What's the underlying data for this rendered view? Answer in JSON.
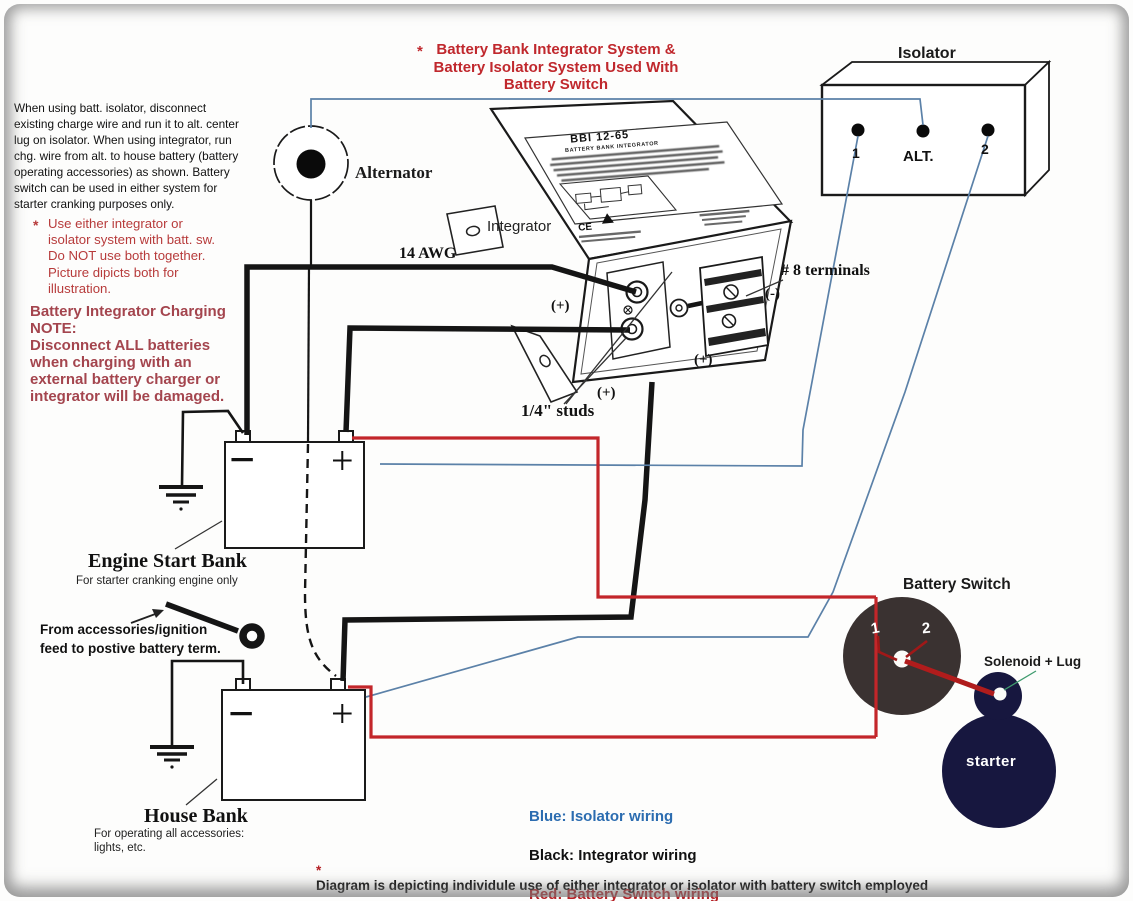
{
  "title": {
    "asterisk": "*",
    "line1": "Battery Bank Integrator System &",
    "line2": "Battery Isolator System Used With",
    "line3": "Battery Switch",
    "color": "#c0282d"
  },
  "intro_note": "When using batt. isolator, disconnect\n existing charge wire and run it to alt. center\nlug on isolator.  When using  integrator, run\nchg. wire from alt. to house battery (battery\noperating accessories) as shown. Battery\nswitch can be used in either system for\nstarter cranking purposes only.",
  "usage_note": {
    "asterisk": "*",
    "text": "Use either integrator or\nisolator system with batt. sw.\nDo NOT use both together.\nPicture dipicts both for\nillustration."
  },
  "charging_note": "Battery Integrator Charging\nNOTE:\nDisconnect ALL batteries\nwhen charging with an\nexternal battery charger or\nintegrator will be damaged.",
  "alternator": {
    "label": "Alternator"
  },
  "integrator": {
    "label": "Integrator",
    "device_title": "BBI 12-65",
    "device_subtitle": "BATTERY BANK INTEGRATOR",
    "ce_mark": "CE",
    "wire_gauge": "14 AWG",
    "terminals_label": "# 8 terminals",
    "studs_label": "1/4\" studs",
    "plus_upper": "(+)",
    "plus_lower": "(+)",
    "plus_block": "(+)",
    "minus_label": "(-)"
  },
  "isolator": {
    "title": "Isolator",
    "terminal_1": "1",
    "terminal_alt": "ALT.",
    "terminal_2": "2"
  },
  "engine_bank": {
    "title": "Engine Start Bank",
    "subtitle": "For starter cranking engine only",
    "minus": "−",
    "plus": "+"
  },
  "house_bank": {
    "title": "House Bank",
    "subtitle": "For operating all accessories:\nlights, etc.",
    "minus": "−",
    "plus": "+"
  },
  "accessories_note": "From accessories/ignition\n feed to postive battery term.",
  "battery_switch": {
    "title": "Battery Switch",
    "pos_1": "1",
    "pos_2": "2"
  },
  "solenoid": {
    "label": "Solenoid + Lug"
  },
  "starter": {
    "label": "starter"
  },
  "legend": {
    "blue": "Blue: Isolator wiring",
    "black": "Black: Integrator wiring",
    "red": "Red: Battery Switch wiring",
    "blue_color": "#2b6cb0",
    "black_color": "#111111",
    "red_color": "#b52025"
  },
  "footer_note": {
    "asterisk": "*",
    "text": "Diagram is depicting individule use of either integrator or isolator with battery switch employed"
  },
  "colors": {
    "wire_blue": "#5b81a8",
    "wire_black": "#151515",
    "wire_red": "#c3262a",
    "switch_body": "#3a3231",
    "starter_navy": "#17173f"
  }
}
